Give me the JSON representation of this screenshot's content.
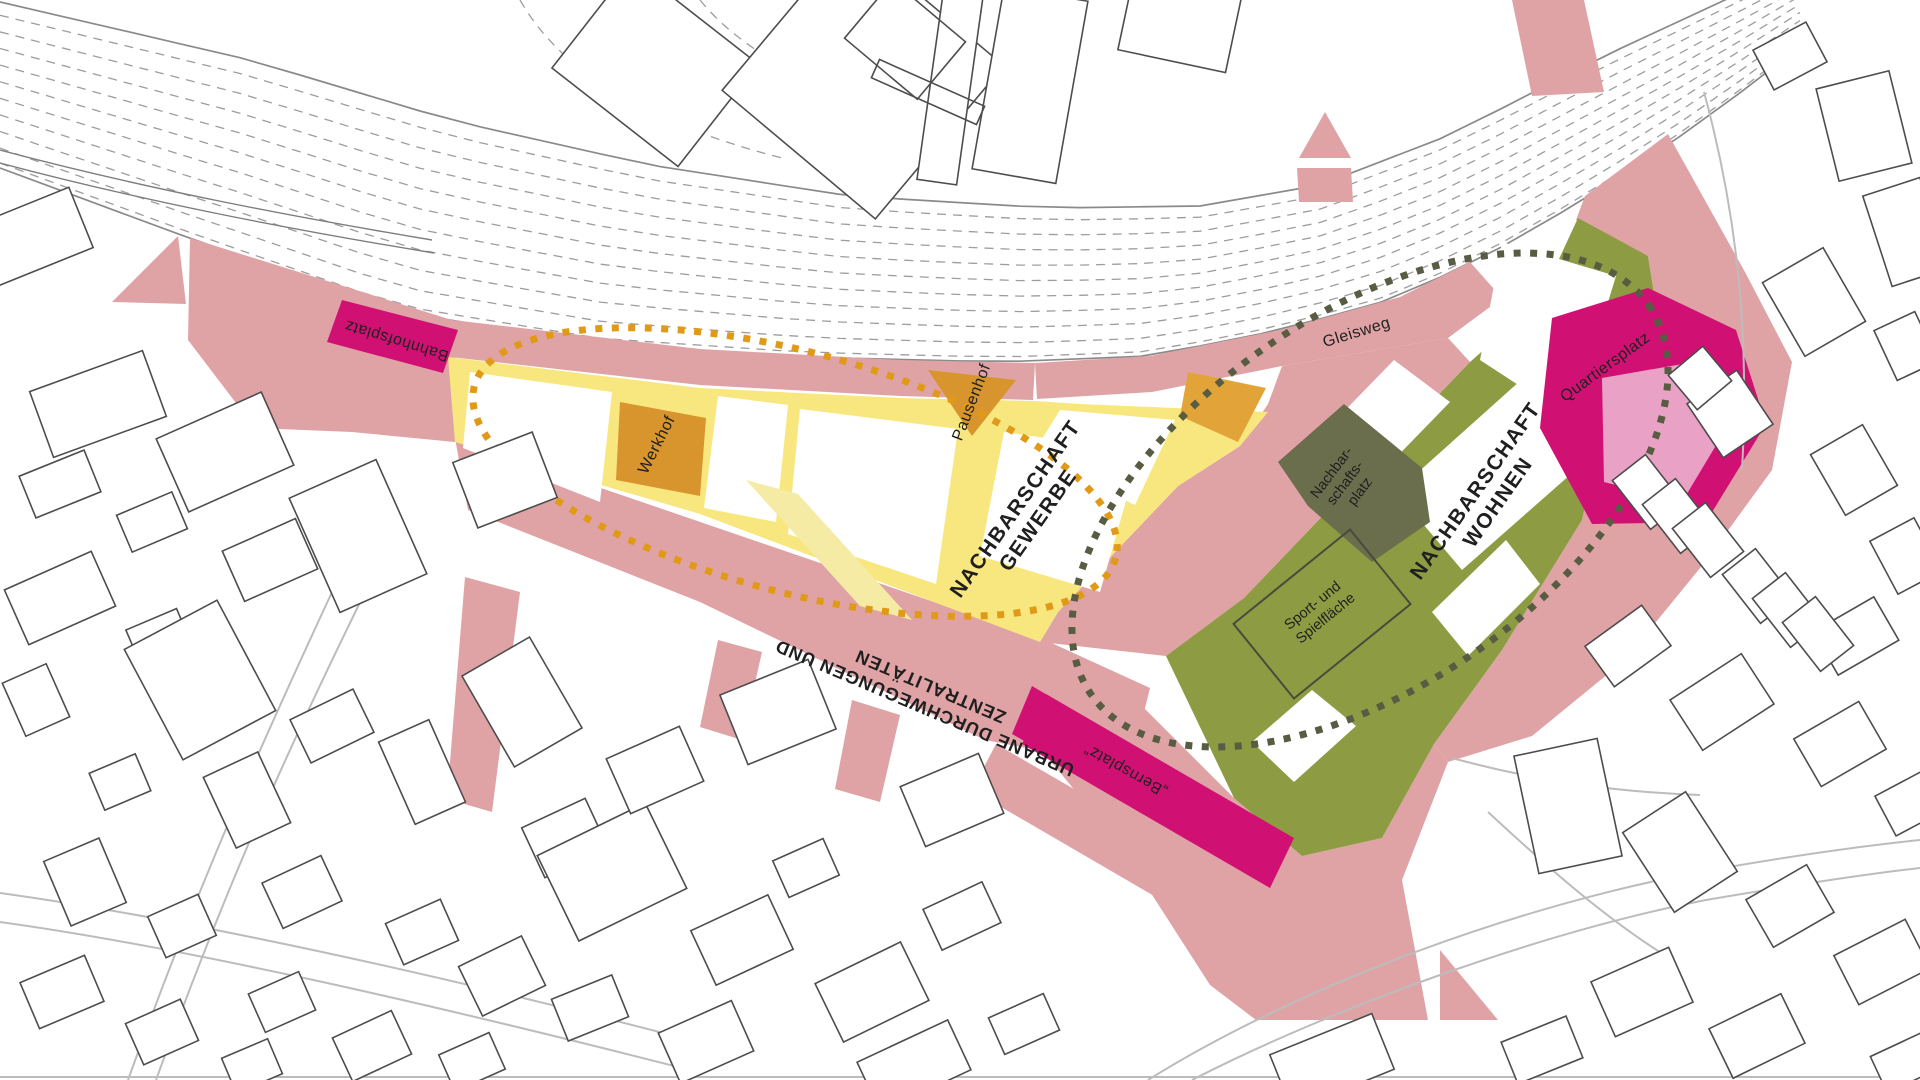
{
  "map": {
    "colors": {
      "pink": "#DFA3A6",
      "magenta": "#D01173",
      "light_pink": "#E9A2C5",
      "yellow": "#F8E77E",
      "pale_yellow": "#F5EBA4",
      "orange": "#D8952D",
      "orange_accent": "#E2A438",
      "orange_dots": "#E19A18",
      "olive": "#8D9C43",
      "dark_olive": "#6A6E4D",
      "olive_dots": "#575C42"
    },
    "neighborhoods": {
      "gewerbe": {
        "line1": "NACHBARSCHAFT",
        "line2": "GEWERBE"
      },
      "wohnen": {
        "line1": "NACHBARSCHAFT",
        "line2": "WOHNEN"
      }
    },
    "corridor": {
      "line1": "URBANE DURCHWEGUNGEN UND",
      "line2": "ZENTRALITÄTEN"
    },
    "places": {
      "bahnhofsplatz": {
        "label": "Bahnhofsplatz"
      },
      "werkhof": {
        "label": "Werkhof"
      },
      "pausenhof": {
        "label": "Pausenhof"
      },
      "gleisweg": {
        "label": "Gleisweg"
      },
      "nachbarschaftsplatz": {
        "line1": "Nachbar-",
        "line2": "schafts-",
        "line3": "platz"
      },
      "quartiersplatz": {
        "label": "Quartiersplatz"
      },
      "sportflaeche": {
        "line1": "Sport- und",
        "line2": "Spielfläche"
      },
      "bernsplatz": {
        "label": "„Bernsplatz“"
      }
    }
  }
}
